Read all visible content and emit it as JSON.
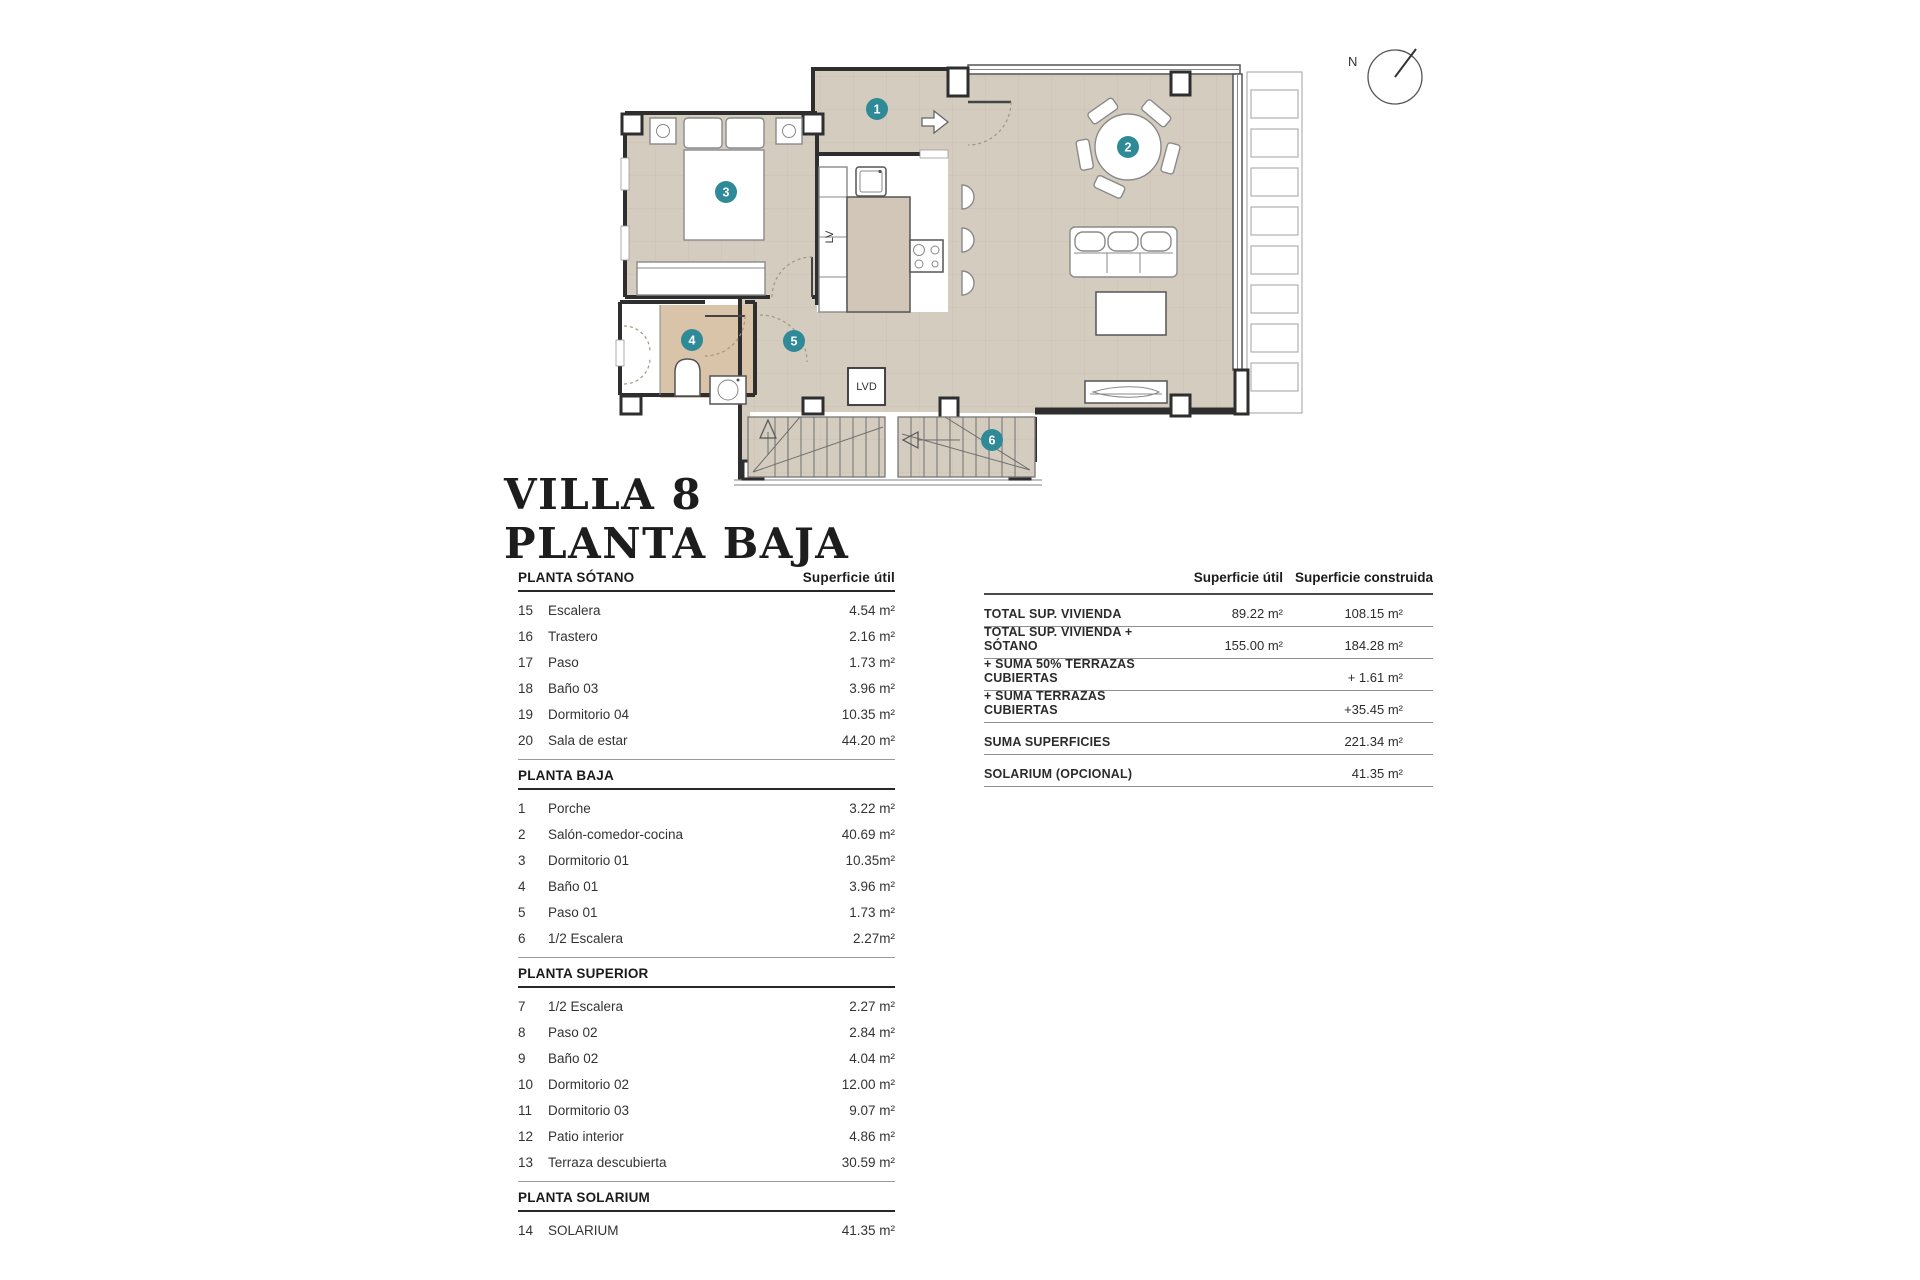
{
  "title": {
    "line1": "VILLA 8",
    "line2": "PLANTA BAJA"
  },
  "plan": {
    "labels": {
      "lv": "LV",
      "lvd": "LVD",
      "north": "N"
    },
    "markers": [
      {
        "num": "1",
        "x": 387,
        "y": 99
      },
      {
        "num": "2",
        "x": 638,
        "y": 137
      },
      {
        "num": "3",
        "x": 236,
        "y": 182
      },
      {
        "num": "4",
        "x": 202,
        "y": 330
      },
      {
        "num": "5",
        "x": 304,
        "y": 331
      },
      {
        "num": "6",
        "x": 502,
        "y": 430
      }
    ],
    "colors": {
      "floor": "#d5ccc0",
      "grid": "#c8bfb1",
      "bath": "#d9c3a9",
      "island": "#d1c6b7",
      "wall": "#2e2e2e",
      "teal": "#2e8a96"
    }
  },
  "left_table": {
    "value_header": "Superficie útil",
    "sections": [
      {
        "heading": "PLANTA SÓTANO",
        "rows": [
          {
            "num": "15",
            "name": "Escalera",
            "value": "4.54 m²"
          },
          {
            "num": "16",
            "name": "Trastero",
            "value": "2.16 m²"
          },
          {
            "num": "17",
            "name": "Paso",
            "value": "1.73 m²"
          },
          {
            "num": "18",
            "name": "Baño 03",
            "value": "3.96 m²"
          },
          {
            "num": "19",
            "name": "Dormitorio 04",
            "value": "10.35 m²"
          },
          {
            "num": "20",
            "name": "Sala de estar",
            "value": "44.20 m²"
          }
        ]
      },
      {
        "heading": "PLANTA BAJA",
        "rows": [
          {
            "num": "1",
            "name": "Porche",
            "value": "3.22 m²"
          },
          {
            "num": "2",
            "name": "Salón-comedor-cocina",
            "value": "40.69 m²"
          },
          {
            "num": "3",
            "name": "Dormitorio 01",
            "value": "10.35m²"
          },
          {
            "num": "4",
            "name": "Baño 01",
            "value": "3.96 m²"
          },
          {
            "num": "5",
            "name": "Paso 01",
            "value": "1.73 m²"
          },
          {
            "num": "6",
            "name": "1/2 Escalera",
            "value": "2.27m²"
          }
        ]
      },
      {
        "heading": "PLANTA SUPERIOR",
        "rows": [
          {
            "num": "7",
            "name": "1/2 Escalera",
            "value": "2.27 m²"
          },
          {
            "num": "8",
            "name": "Paso 02",
            "value": "2.84 m²"
          },
          {
            "num": "9",
            "name": "Baño 02",
            "value": "4.04 m²"
          },
          {
            "num": "10",
            "name": "Dormitorio 02",
            "value": "12.00 m²"
          },
          {
            "num": "11",
            "name": "Dormitorio 03",
            "value": "9.07 m²"
          },
          {
            "num": "12",
            "name": "Patio interior",
            "value": "4.86 m²"
          },
          {
            "num": "13",
            "name": "Terraza descubierta",
            "value": "30.59 m²"
          }
        ]
      },
      {
        "heading": "PLANTA SOLARIUM",
        "rows": [
          {
            "num": "14",
            "name": "SOLARIUM",
            "value": "41.35 m²"
          }
        ]
      }
    ]
  },
  "summary_table": {
    "col1_header": "Superficie útil",
    "col2_header": "Superficie construida",
    "rows": [
      {
        "label": "TOTAL SUP. VIVIENDA",
        "util": "89.22 m²",
        "construida": "108.15 m²"
      },
      {
        "label": "TOTAL SUP. VIVIENDA + SÓTANO",
        "util": "155.00 m²",
        "construida": "184.28 m²"
      },
      {
        "label": "+ SUMA 50% TERRAZAS CUBIERTAS",
        "util": "",
        "construida": "+ 1.61 m²"
      },
      {
        "label": "+ SUMA TERRAZAS CUBIERTAS",
        "util": "",
        "construida": "+35.45 m²"
      },
      {
        "label": "SUMA SUPERFICIES",
        "util": "",
        "construida": "221.34 m²"
      },
      {
        "label": "SOLARIUM (OPCIONAL)",
        "util": "",
        "construida": "41.35 m²"
      }
    ]
  }
}
